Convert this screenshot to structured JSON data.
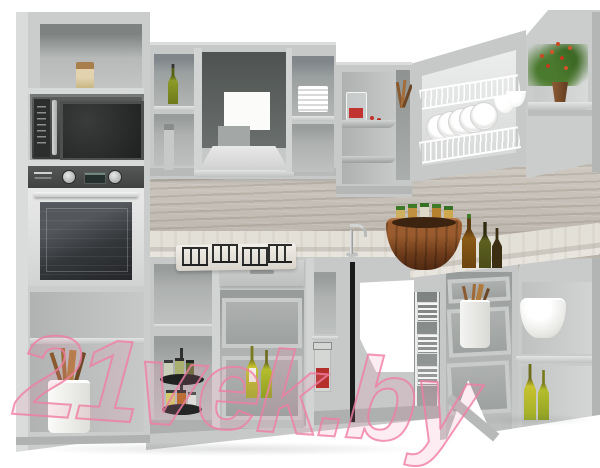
{
  "type": "product-photo",
  "scene": {
    "subject": "3D render of an L-shaped corner kitchen set with light grey fronts, open carcasses without doors, built-in appliances and decor props, on a plain white background",
    "palette": {
      "background": "#ffffff",
      "cabinet_grey": "#c7c9c8",
      "carcass_interior": "#9aa09f",
      "backsplash_wood": "#bfb9af",
      "countertop_marble": "#ddd9d1",
      "appliance_graphite": "#3c3e3d",
      "watermark_pink": "#f07da4",
      "olive_bottle_green": "#b0b82b",
      "wood_bowl_brown": "#6b3a1a"
    },
    "objects": [
      "tall oven housing column with open top shelf and storage jar",
      "graphite microwave oven in niche",
      "built-in oven with two control knobs and dark glass door",
      "open base shelves with ceramic crock of wooden utensils",
      "wall cubby with olive oil bottle",
      "wall cubby with spray bottle",
      "cooker hood housing with trapezoid hood and duct",
      "wall cubby with stack of white plates",
      "corner wall cabinet with curved shelves and jug of strawberries",
      "niche with wooden spoons",
      "dish drying cabinet with two white wire racks, plates and bowls",
      "right end wall unit with chamfered top and potted berry plant on corner shelf",
      "wood-grain backsplash panel",
      "light marble countertop",
      "four-burner gas hob with black cast-iron grates",
      "chrome sink faucet at the corner",
      "wooden barrel bowl with green-capped spice jars",
      "amber and olive glass bottles on the counter",
      "two-tier black rotating spice carousel with jars",
      "base drawer unit with open metal-box drawers and olive oil bottles",
      "glass clip-top jar with red sauce on base shelf",
      "corner sink cabinet with open white cut-out",
      "pull-out chrome wire bottle basket",
      "base drawer boxes with pot of wooden utensils",
      "rounded open corner base unit with white mixing bowl and olive oil bottles"
    ]
  },
  "watermark": {
    "text": "21vek.by",
    "color": "#f07da4"
  }
}
